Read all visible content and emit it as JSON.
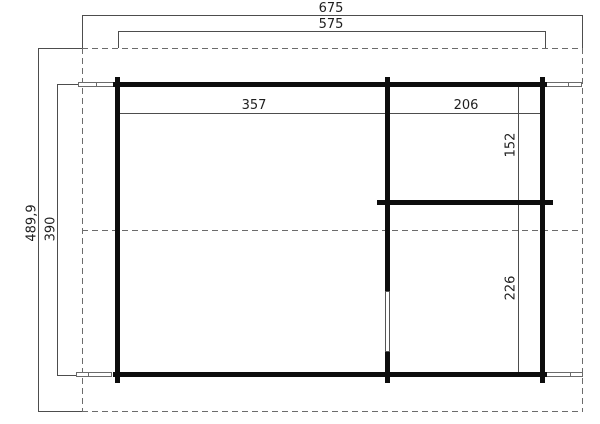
{
  "plan": {
    "dims": {
      "total_width": "675",
      "body_width": "575",
      "left_room_width": "357",
      "right_room_width": "206",
      "right_room_top_depth": "152",
      "right_room_bottom_depth": "226",
      "body_depth": "390",
      "total_depth": "489,9"
    },
    "colors": {
      "wall": "#0d0d0d",
      "dimension_line": "#4d4d4d",
      "dashed_line": "#6b6b6b",
      "label_text": "#1f1f1f",
      "background": "#ffffff"
    }
  }
}
